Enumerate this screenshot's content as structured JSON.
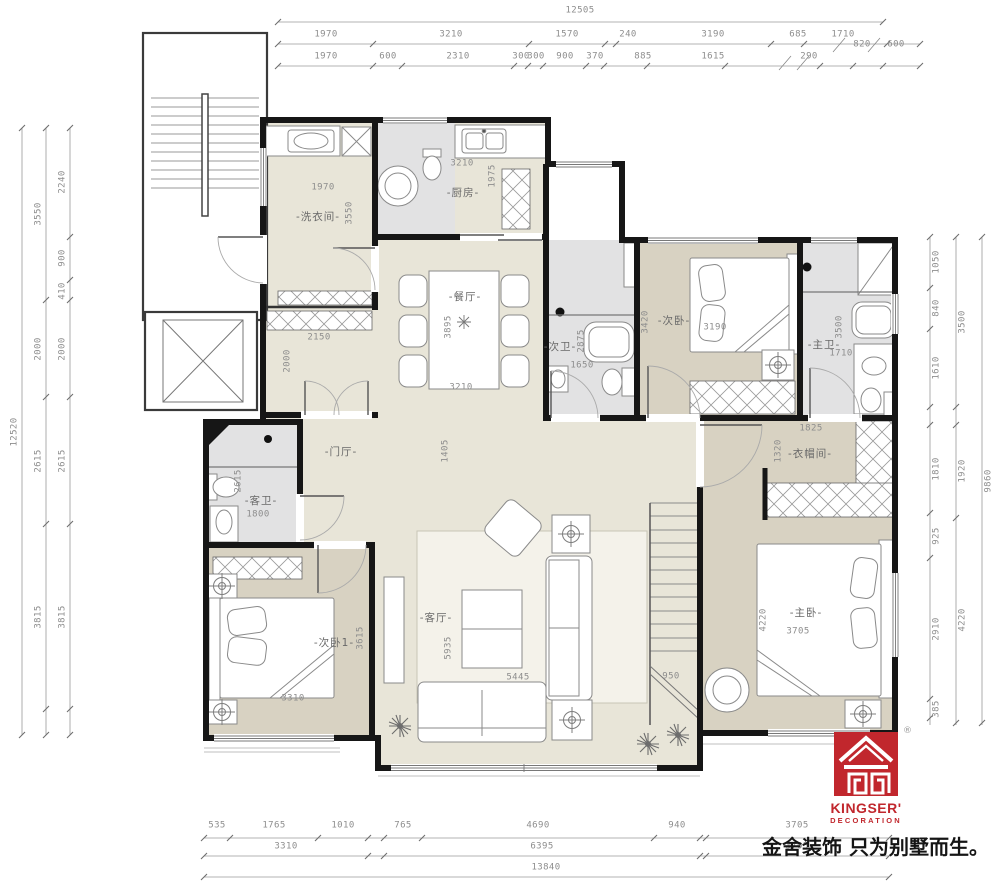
{
  "palette": {
    "wall": "#161616",
    "floor": "#e8e5d8",
    "bedroom_floor": "#d8d2c2",
    "bath_floor": "#e2e2e3",
    "rug": "#f4f2ea",
    "dimension_text": "#8d8d8d",
    "accent_red": "#c1272d"
  },
  "dims": {
    "top": {
      "row1": [
        "12505"
      ],
      "row2": [
        "1970",
        "3210",
        "1570",
        "240",
        "3190",
        "685",
        "1710",
        "820",
        "600"
      ],
      "row3": [
        "1970",
        "600",
        "2310",
        "300",
        "300",
        "900",
        "370",
        "885",
        "1615",
        "290"
      ]
    },
    "left": {
      "outer": [
        "12520"
      ],
      "middle": [
        "3550",
        "2000",
        "2615",
        "3815"
      ],
      "inner": [
        "2240",
        "900",
        "410",
        "2000",
        "2615",
        "3815"
      ]
    },
    "right": {
      "inner": [
        "1050",
        "840",
        "1610",
        "1810",
        "925",
        "2910",
        "385"
      ],
      "middle": [
        "3500",
        "1920",
        "4220"
      ],
      "outer": [
        "9860"
      ]
    },
    "bottom": {
      "row1": [
        "535",
        "1765",
        "1010",
        "765",
        "4690",
        "940",
        "3705"
      ],
      "row2": [
        "3310",
        "6395",
        "3705"
      ],
      "row3": [
        "13840"
      ]
    }
  },
  "rooms": {
    "laundry": {
      "label": "-洗衣间-",
      "width": "1970",
      "depth": "3550"
    },
    "kitchen": {
      "label": "-厨房-",
      "width": "3210",
      "depth": "1975"
    },
    "dining": {
      "label": "-餐厅-",
      "width": "3210",
      "depth": "3895"
    },
    "bath2": {
      "label": "-次卫-",
      "width": "1650",
      "depth": "2875"
    },
    "bedroom2": {
      "label": "-次卧-",
      "width": "3190",
      "depth": "3420"
    },
    "master_bath": {
      "label": "-主卫-",
      "width": "1710",
      "depth": "3500"
    },
    "foyer": {
      "label": "-门厅-",
      "depth": "1405"
    },
    "vestibule": {
      "width": "2150",
      "depth": "2000"
    },
    "guest_bath": {
      "label": "-客卫-",
      "width": "1800",
      "depth": "2615"
    },
    "cloakroom": {
      "label": "-衣帽间-",
      "width": "1825",
      "depth": "1320"
    },
    "bedroom1": {
      "label": "-次卧1-",
      "width": "3310",
      "depth": "3615"
    },
    "living": {
      "label": "-客厅-",
      "width": "5445",
      "depth": "5935"
    },
    "master": {
      "label": "-主卧-",
      "width": "3705",
      "depth": "4220"
    },
    "stair": {
      "width": "950"
    }
  },
  "branding": {
    "logo_text": "KINGSER'",
    "logo_subtext": "DECORATION",
    "registered": "®",
    "tagline": "金舍装饰 只为别墅而生。"
  }
}
